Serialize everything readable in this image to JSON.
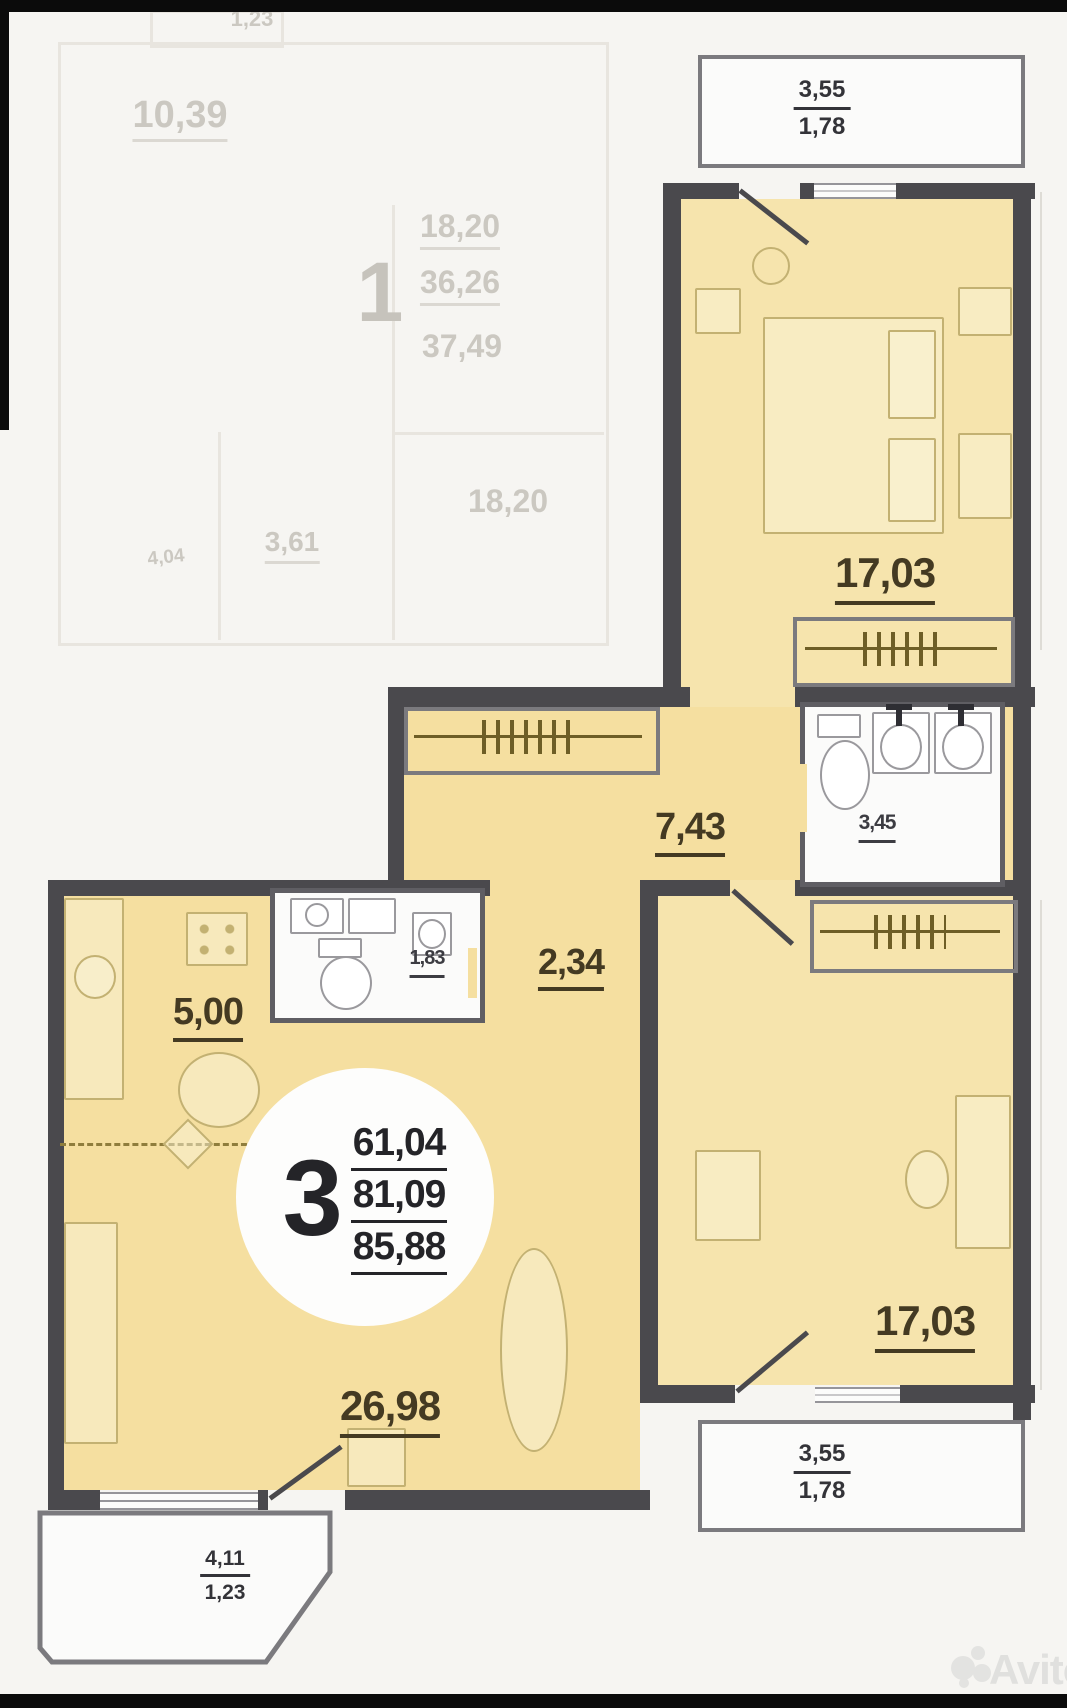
{
  "unit": {
    "badge": {
      "number": "3",
      "area_living": "61,04",
      "area_usable": "81,09",
      "area_total": "85,88"
    },
    "rooms": {
      "bedroom_top": "17,03",
      "bedroom_bottom": "17,03",
      "hall": "7,43",
      "bathroom": "3,45",
      "wc": "1,83",
      "corridor": "2,34",
      "kitchen": "5,00",
      "living": "26,98"
    },
    "balconies": {
      "top_right": {
        "full": "3,55",
        "reduced": "1,78"
      },
      "bottom_right": {
        "full": "3,55",
        "reduced": "1,78"
      },
      "bottom_left": {
        "full": "4,11",
        "reduced": "1,23"
      }
    }
  },
  "faded_unit": {
    "badge": {
      "number": "1",
      "a1": "18,20",
      "a2": "36,26",
      "a3": "37,49"
    },
    "labels": {
      "balcony": "1,23",
      "room_top": "10,39",
      "room_bottom": "18,20",
      "small": "3,61",
      "tiny": "4,04"
    }
  },
  "watermark": {
    "brand": "Avito"
  }
}
